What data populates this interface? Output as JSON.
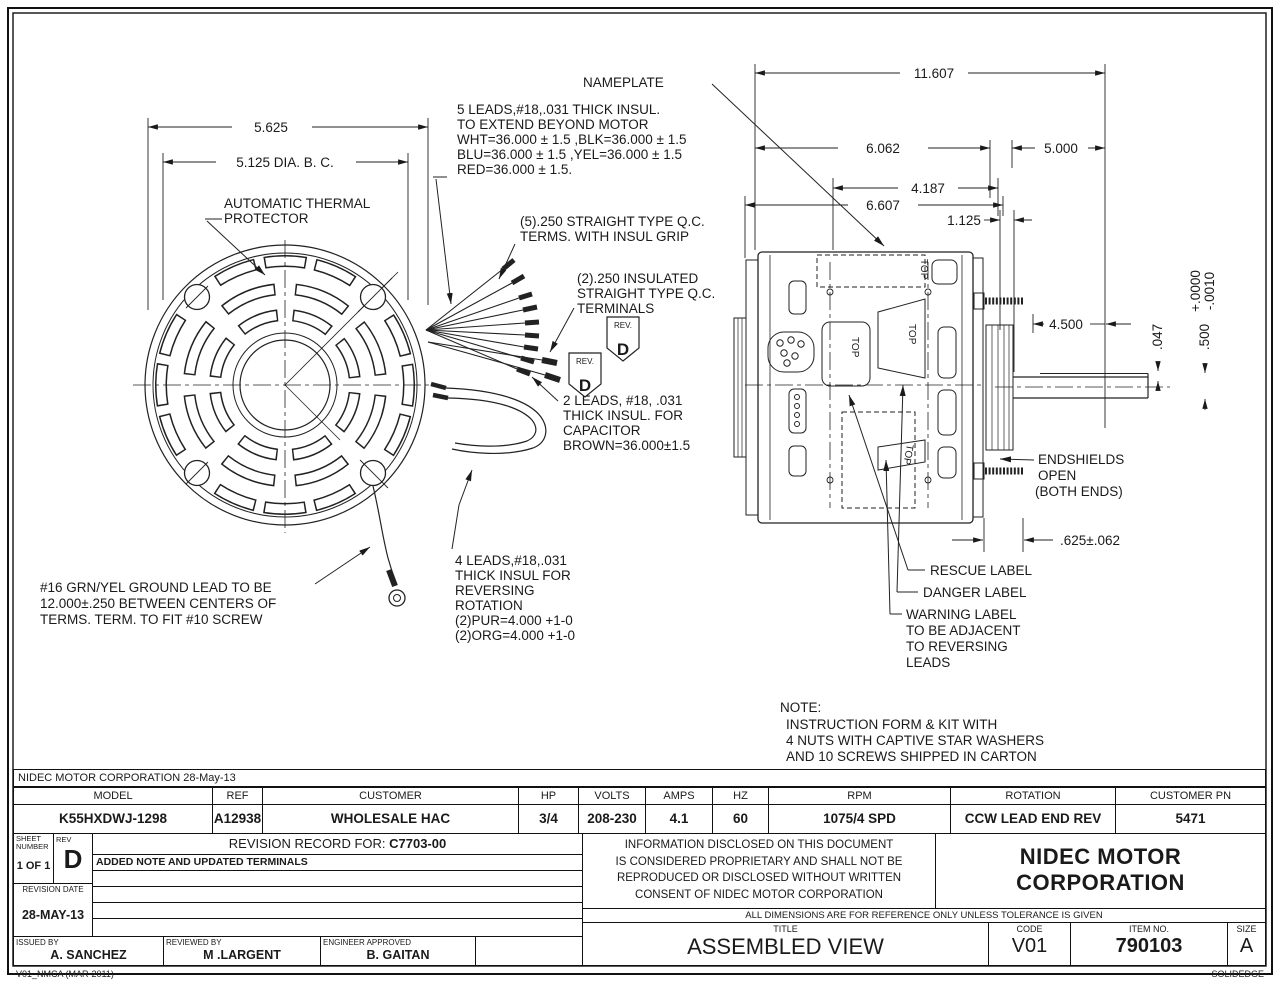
{
  "colors": {
    "ink": "#1a1a1a",
    "paper": "#ffffff"
  },
  "drawing": {
    "labels": {
      "nameplate": "NAMEPLATE",
      "thermal": [
        "AUTOMATIC THERMAL",
        "PROTECTOR"
      ],
      "leads5": [
        "5 LEADS,#18,.031 THICK INSUL.",
        "TO EXTEND BEYOND MOTOR",
        "WHT=36.000 ± 1.5 ,BLK=36.000 ± 1.5",
        "BLU=36.000 ± 1.5 ,YEL=36.000 ± 1.5",
        "RED=36.000 ± 1.5."
      ],
      "qc5": [
        "(5).250 STRAIGHT TYPE Q.C.",
        "TERMS. WITH INSUL GRIP"
      ],
      "qc2": [
        "(2).250 INSULATED",
        "STRAIGHT TYPE Q.C.",
        "TERMINALS"
      ],
      "rev_flag_small": "REV.",
      "rev_flag_letter": "D",
      "leads2": [
        "2 LEADS, #18, .031",
        "THICK INSUL. FOR",
        "CAPACITOR",
        "BROWN=36.000±1.5"
      ],
      "leads4": [
        "4 LEADS,#18,.031",
        "THICK INSUL FOR",
        "REVERSING",
        "ROTATION",
        "(2)PUR=4.000 +1-0",
        "(2)ORG=4.000 +1-0"
      ],
      "ground": [
        "#16 GRN/YEL GROUND LEAD TO BE",
        "12.000±.250 BETWEEN CENTERS OF",
        "TERMS. TERM. TO FIT #10 SCREW"
      ],
      "endshields": [
        "ENDSHIELDS",
        "OPEN",
        "(BOTH ENDS)"
      ],
      "rescue": "RESCUE LABEL",
      "danger": "DANGER LABEL",
      "warning": [
        "WARNING LABEL",
        "TO BE ADJACENT",
        "TO REVERSING",
        "LEADS"
      ],
      "note": [
        "NOTE:",
        "INSTRUCTION FORM & KIT WITH",
        "4 NUTS WITH CAPTIVE STAR WASHERS",
        "AND 10 SCREWS  SHIPPED IN CARTON"
      ],
      "top": "TOP"
    },
    "dims": {
      "d5625": "5.625",
      "d5125": "5.125 DIA. B. C.",
      "d11607": "11.607",
      "d6062": "6.062",
      "d5000": "5.000",
      "d4187": "4.187",
      "d6607": "6.607",
      "d1125": "1.125",
      "d4500": "4.500",
      "tol_plus": "+.0000",
      "tol_minus": "-.0010",
      "d047": ".047",
      "d500": ".500",
      "d625": ".625±.062"
    }
  },
  "title_block": {
    "company_line": "NIDEC MOTOR CORPORATION 28-May-13",
    "spec": {
      "headers": [
        "MODEL",
        "REF",
        "CUSTOMER",
        "HP",
        "VOLTS",
        "AMPS",
        "HZ",
        "RPM",
        "ROTATION",
        "CUSTOMER PN"
      ],
      "values": [
        "K55HXDWJ-1298",
        "A12938",
        "WHOLESALE HAC",
        "3/4",
        "208-230",
        "4.1",
        "60",
        "1075/4 SPD",
        "CCW LEAD END REV",
        "5471"
      ]
    },
    "sheet": {
      "label_1": "SHEET",
      "label_2": "NUMBER",
      "value": "1 OF 1"
    },
    "rev": {
      "label": "REV",
      "value": "D"
    },
    "revision_record": {
      "title_pre": "REVISION RECORD FOR: ",
      "title_code": "C7703-00",
      "note": "ADDED NOTE AND UPDATED TERMINALS"
    },
    "revision_date": {
      "label": "REVISION DATE",
      "value": "28-MAY-13"
    },
    "signoff": [
      {
        "label": "ISSUED BY",
        "value": "A. SANCHEZ"
      },
      {
        "label": "REVIEWED BY",
        "value": "M .LARGENT"
      },
      {
        "label": "ENGINEER APPROVED",
        "value": "B. GAITAN"
      }
    ],
    "proprietary": [
      "INFORMATION DISCLOSED ON THIS DOCUMENT",
      "IS CONSIDERED PROPRIETARY AND SHALL NOT BE",
      "REPRODUCED OR DISCLOSED WITHOUT WRITTEN",
      "CONSENT OF NIDEC MOTOR CORPORATION"
    ],
    "company_name": [
      "NIDEC MOTOR",
      "CORPORATION"
    ],
    "tolerance_note": "ALL DIMENSIONS ARE FOR REFERENCE ONLY UNLESS TOLERANCE IS GIVEN",
    "title": {
      "label": "TITLE",
      "value": "ASSEMBLED VIEW"
    },
    "code": {
      "label": "CODE",
      "value": "V01"
    },
    "item": {
      "label": "ITEM NO.",
      "value": "790103"
    },
    "size": {
      "label": "SIZE",
      "value": "A"
    }
  },
  "footer": {
    "left": "V01_NMCA (MAR-2011)",
    "right": "SOLIDEDGE"
  }
}
